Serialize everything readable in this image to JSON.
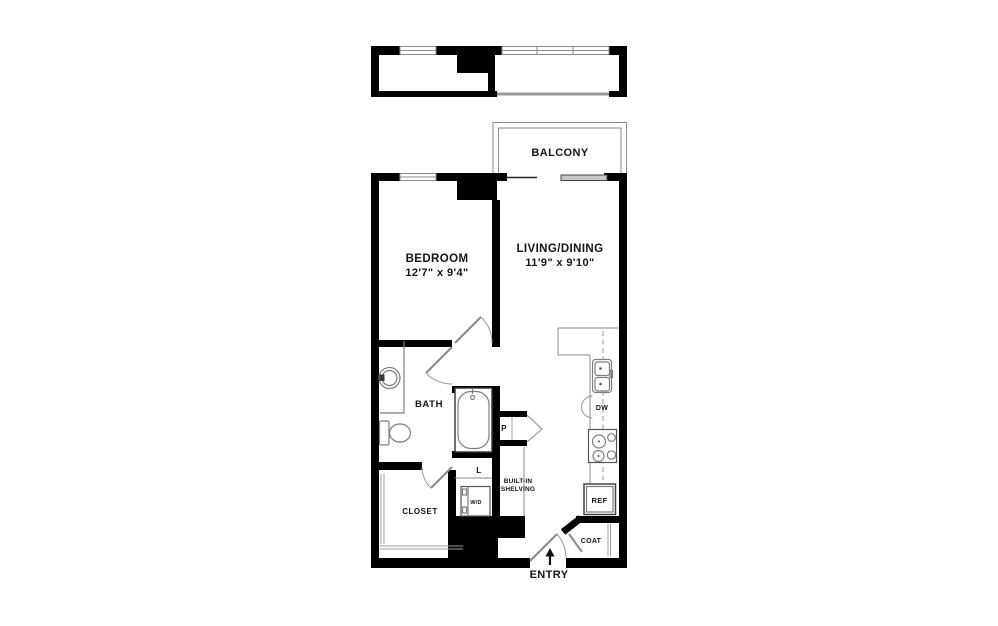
{
  "floorplan": {
    "colors": {
      "wall": "#000000",
      "fixture_line": "#7e7e7e",
      "background": "#ffffff"
    },
    "balcony": {
      "label": "BALCONY"
    },
    "rooms": {
      "bedroom": {
        "name": "BEDROOM",
        "dimensions": "12'7\" x 9'4\""
      },
      "living_dining": {
        "name": "LIVING/DINING",
        "dimensions": "11'9\" x 9'10\""
      },
      "bath": {
        "name": "BATH"
      },
      "closet": {
        "name": "CLOSET"
      },
      "coat_closet": {
        "name": "COAT"
      }
    },
    "features": {
      "pantry": "P",
      "linen": "L",
      "washer_dryer": "W/D",
      "dishwasher": "DW",
      "refrigerator": "REF",
      "built_in_shelving_line1": "BUILT-IN",
      "built_in_shelving_line2": "SHELVING"
    },
    "entry": {
      "label": "ENTRY",
      "arrow_icon": "up-arrow"
    }
  }
}
